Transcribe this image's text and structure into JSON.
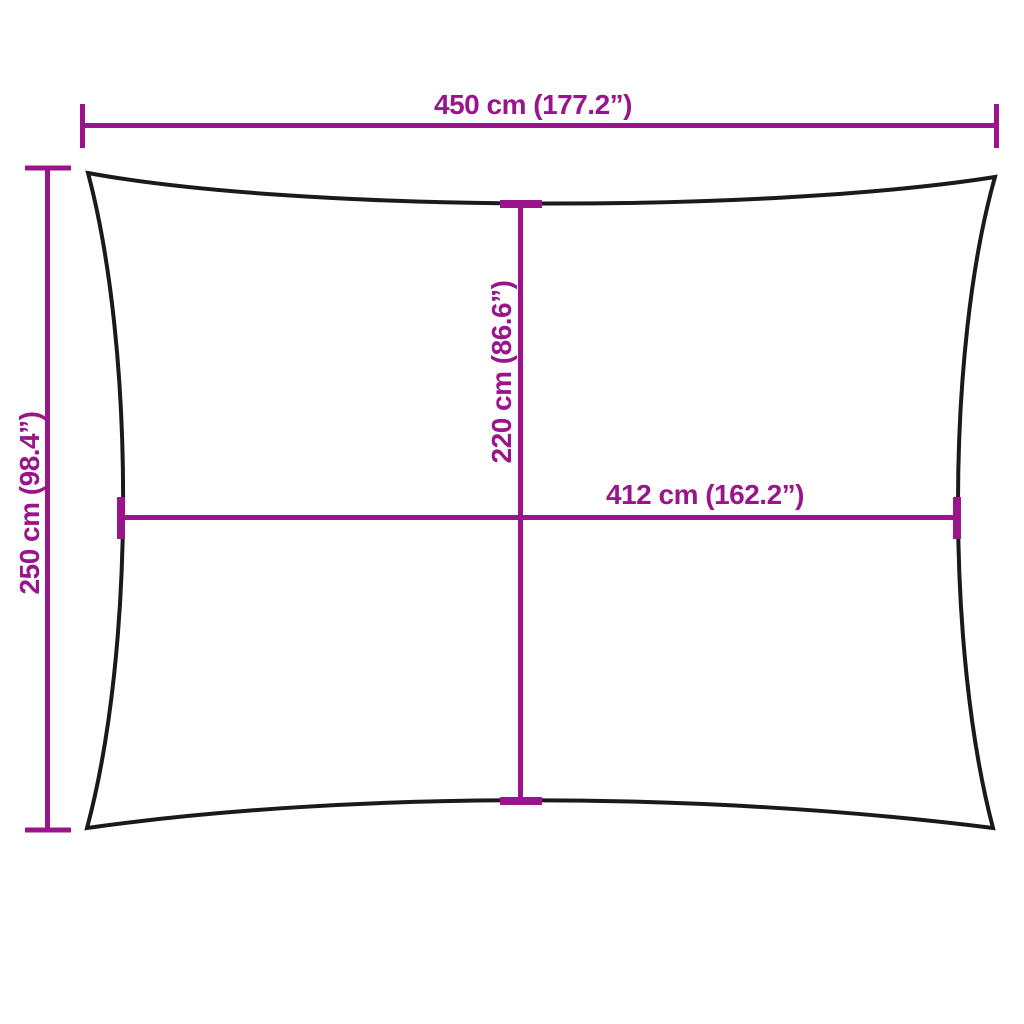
{
  "colors": {
    "accent": "#9a158b",
    "outline": "#1a1a1a",
    "background": "#ffffff"
  },
  "diagram": {
    "dimensions": {
      "top_width": "450 cm (177.2”)",
      "left_height": "250 cm (98.4”)",
      "inner_height": "220 cm (86.6”)",
      "inner_width": "412 cm (162.2”)"
    }
  }
}
